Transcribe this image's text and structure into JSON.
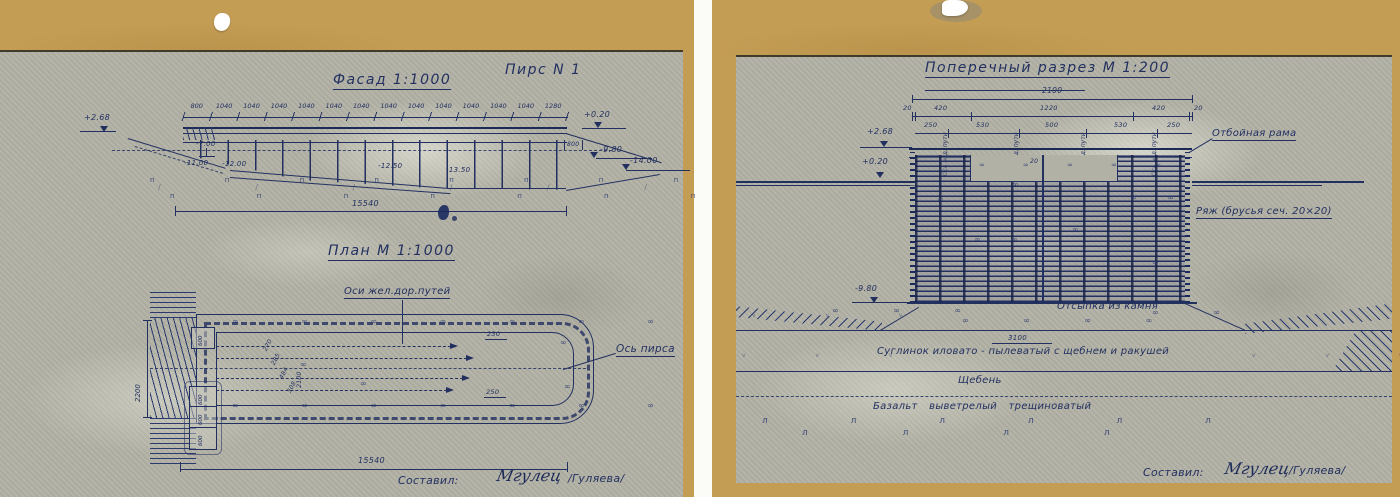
{
  "left_page": {
    "facade": {
      "title": "Фасад 1:1000",
      "pier_label": "Пирс N 1",
      "top_dims": [
        "800",
        "1040",
        "1040",
        "1040",
        "1040",
        "1040",
        "1040",
        "1040",
        "1040",
        "1040",
        "1040",
        "1040",
        "1040",
        "1280"
      ],
      "elev_top_left": "+2.68",
      "elev_deck_right": "+0.20",
      "dim_right_small": "800",
      "elev_right_1": "-9.80",
      "elev_right_2": "-14.00",
      "depth_1": "-7.00",
      "depth_2": "-11.00",
      "depth_3": "-12.00",
      "depth_4": "-12.50",
      "depth_5": "-13.50",
      "overall_dim": "15540"
    },
    "plan": {
      "title": "План М 1:1000",
      "rail_axes_label": "Оси жел.дор.путей",
      "pier_axis_label": "Ось пирса",
      "shore_dim": "2200",
      "axis_dim": "2100",
      "diag_dims": [
        "270",
        "285",
        "484",
        "308"
      ],
      "block_dim_upper": "600",
      "block_dims_lower": [
        "600",
        "600",
        "600"
      ],
      "end_dim_top": "230",
      "end_dim_bottom": "250",
      "overall_dim": "15540"
    },
    "credit": {
      "prefix": "Составил:",
      "signature": "Мгулец",
      "countersign": "/Гуляева/"
    }
  },
  "right_page": {
    "section": {
      "title": "Поперечный разрез М 1:200",
      "overall_dim": "2100",
      "dims_row1": [
        "20",
        "420",
        "1220",
        "420",
        "20"
      ],
      "dims_row2": [
        "250",
        "530",
        "500",
        "530",
        "250"
      ],
      "rail_axis_label": "Ось ж.д. пути",
      "elev_1": "+2.68",
      "elev_2": "+0.20",
      "elev_3": "-9.80",
      "notch_dim": "20",
      "fender_label": "Отбойная рама",
      "crib_label": "Ряж (брусья сеч. 20×20)",
      "stone_fill_label": "Отсыпка из камня",
      "loam_dim": "3100",
      "loam_label": "Суглинок иловато - пылеватый с щебнем и ракушей",
      "gravel_label": "Щебень",
      "basalt_label": "Базальт выветрелый трещиноватый"
    },
    "credit": {
      "prefix": "Составил:",
      "signature": "Мгулец",
      "countersign": "/Гуляева/"
    }
  }
}
